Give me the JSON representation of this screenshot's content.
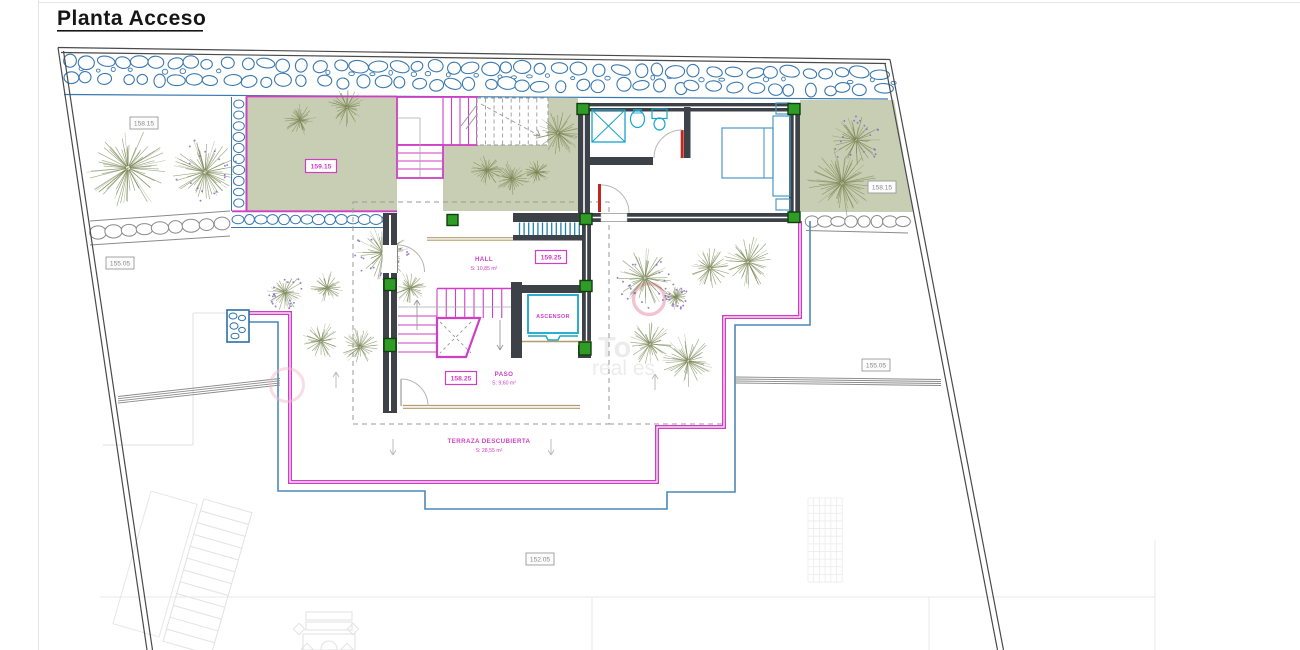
{
  "title": "Planta Acceso",
  "colors": {
    "magenta": "#cf3fc4",
    "blue_line": "#4c88b8",
    "rock_blue": "#3a79b0",
    "wall": "#3c4248",
    "green_fill": "#c8ceb3",
    "column_green": "#2f9c27",
    "column_green_border": "#113f0e",
    "cyan": "#17a5c9",
    "door_red": "#c0281e",
    "tree": "#808c58",
    "tree_dot": "#8468c4",
    "label_gray": "#8a8a8a",
    "tan": "#b49a6e",
    "dash_gray": "#9a9a9a",
    "boundary": "#4a4a4a",
    "faint": "#e2e2e2",
    "pink_ring": "#f2bcca",
    "arc_gray": "#b5b5b5"
  },
  "rooms": {
    "hall": {
      "name": "HALL",
      "area": "S: 10,85 m²"
    },
    "paso": {
      "name": "PASO",
      "area": "S: 9,60 m²"
    },
    "ascensor": {
      "name": "ASCENSOR"
    },
    "terraza": {
      "name": "TERRAZA DESCUBIERTA",
      "area": "S: 28,55 m²"
    }
  },
  "elevation_labels": [
    {
      "value": "158.15",
      "style": "gray"
    },
    {
      "value": "155.05",
      "style": "gray"
    },
    {
      "value": "159.15",
      "style": "magenta"
    },
    {
      "value": "159.25",
      "style": "magenta"
    },
    {
      "value": "158.25",
      "style": "magenta"
    },
    {
      "value": "158.15",
      "style": "gray"
    },
    {
      "value": "155.05",
      "style": "gray"
    },
    {
      "value": "152.05",
      "style": "gray"
    }
  ],
  "watermark": {
    "line1": "To",
    "line2": "real es"
  }
}
